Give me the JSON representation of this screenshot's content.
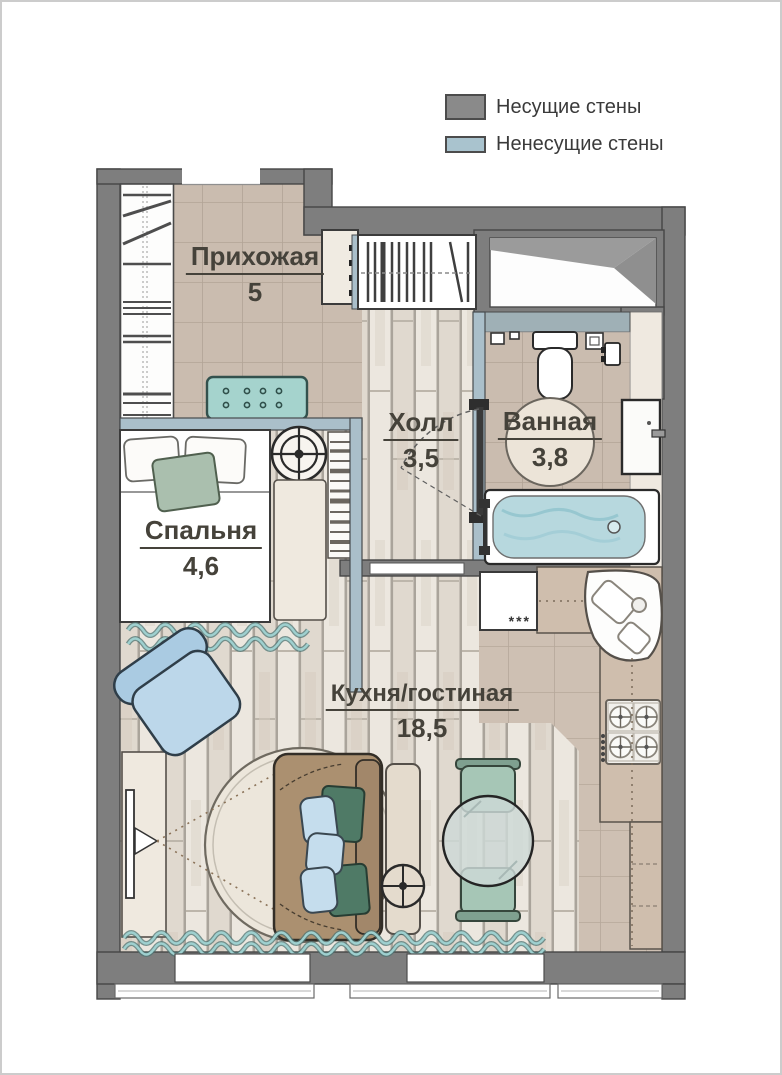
{
  "legend": {
    "load_bearing": {
      "label": "Несущие стены",
      "color": "#8a8a8a"
    },
    "non_load_bearing": {
      "label": "Ненесущие стены",
      "color": "#a9c3ce"
    }
  },
  "rooms": {
    "hallway": {
      "name": "Прихожая",
      "area": "5"
    },
    "hall": {
      "name": "Холл",
      "area": "3,5"
    },
    "bathroom": {
      "name": "Ванная",
      "area": "3,8"
    },
    "bedroom": {
      "name": "Спальня",
      "area": "4,6"
    },
    "kitchen_living": {
      "name": "Кухня/гостиная",
      "area": "18,5"
    }
  },
  "kitchen": {
    "freezer_mark": "***"
  },
  "colors": {
    "wall_load_bearing": "#7e7e7e",
    "wall_partition": "#aabfca",
    "floor_tile": "#cabcaf",
    "floor_wood": "#e8e2da",
    "counter": "#cfbead",
    "bench_teal": "#a5d3cd",
    "armchair_blue": "#bcd7ea",
    "sofa_brown": "#ab9070",
    "water_blue": "#b7d8de"
  }
}
